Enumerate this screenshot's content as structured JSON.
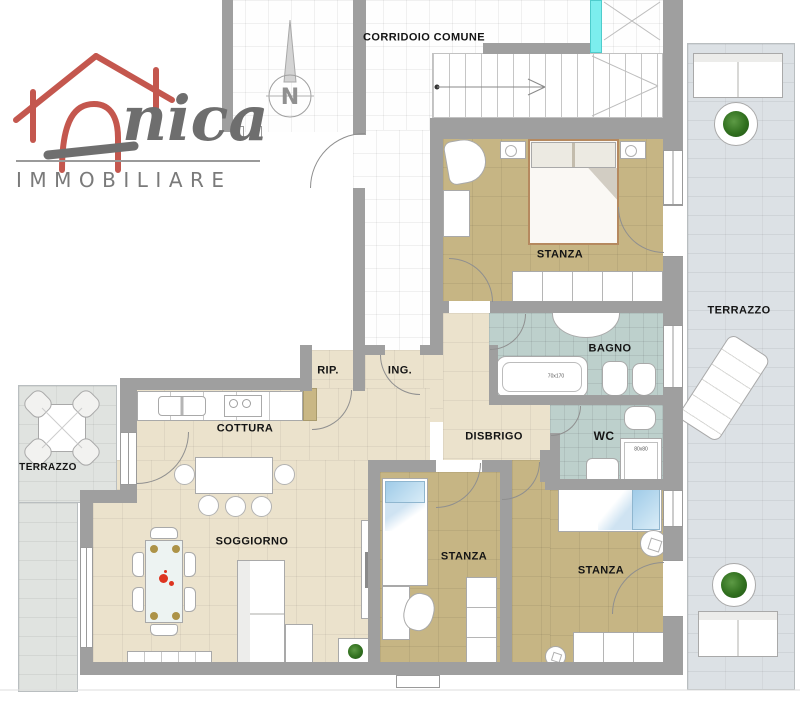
{
  "brand": {
    "logo_script": "nica",
    "logo_subtitle": "IMMOBILIARE"
  },
  "compass": {
    "north_label": "N"
  },
  "labels": {
    "corridor": "CORRIDOIO COMUNE",
    "bedroom_top": "STANZA",
    "terrace_right": "TERRAZZO",
    "bathroom": "BAGNO",
    "wc": "WC",
    "storage": "RIP.",
    "entrance": "ING.",
    "kitchen": "COTTURA",
    "hallway": "DISBRIGO",
    "terrace_left": "TERRAZZO",
    "living_room": "SOGGIORNO",
    "bedroom_center": "STANZA",
    "bedroom_right": "STANZA"
  },
  "fixtures": {
    "bathtub_size": "70x170",
    "shower_size": "80x80"
  },
  "colors": {
    "wall": "#9f9f9f",
    "floor_bedroom": "#c6b584",
    "floor_living": "#ebe2cc",
    "floor_bath": "#bdd0cc",
    "terrace_right": "#dce1e5",
    "terrace_left": "#e0e3e0",
    "elevator_cyan": "#7ceeee",
    "logo_red": "#c4574e",
    "logo_gray": "#6e6e6e",
    "pillow_blue": "#9fcbe8",
    "plant_green": "#31701f",
    "decor_red": "#dd3420",
    "table_gold": "#ad9348"
  }
}
